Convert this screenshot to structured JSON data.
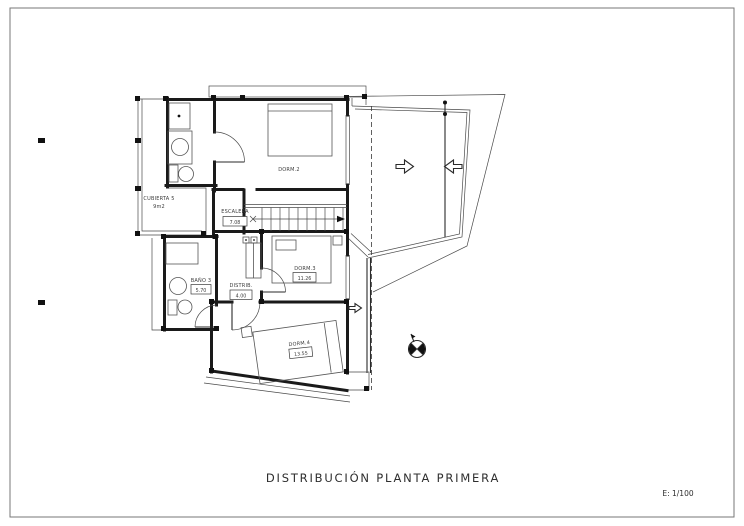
{
  "sheet": {
    "title": "DISTRIBUCIÓN PLANTA PRIMERA",
    "scale_label": "E: 1/100"
  },
  "rooms": {
    "cubierta": {
      "name": "CUBIERTA 5",
      "area": "9m2"
    },
    "escalera": {
      "name": "ESCALERA",
      "area": "7.08"
    },
    "dorm2": {
      "name": "DORM.2"
    },
    "dorm3": {
      "name": "DORM.3",
      "area": "11.26"
    },
    "dorm4": {
      "name": "DORM.4",
      "area": "13.55"
    },
    "bano3": {
      "name": "BAÑO 3",
      "area": "5.70"
    },
    "distrib": {
      "name": "DISTRIB.",
      "area": "4.00"
    }
  },
  "colors": {
    "line": "#1a1a1a",
    "paper": "#ffffff"
  }
}
